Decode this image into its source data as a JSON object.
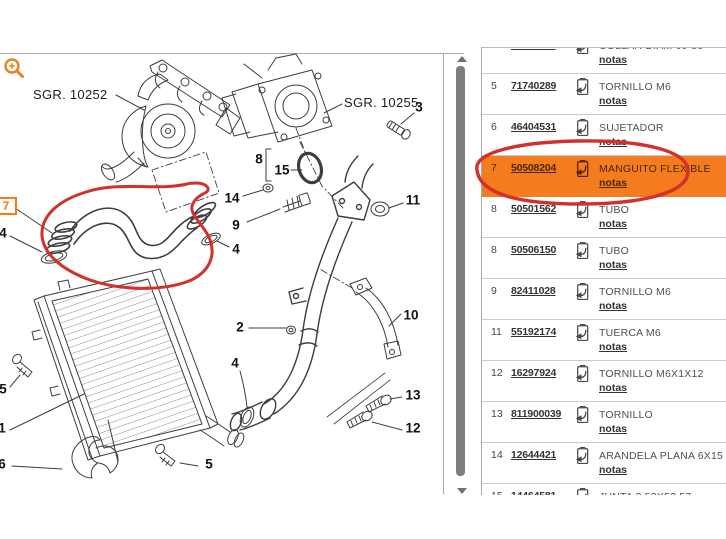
{
  "colors": {
    "accent_orange": "#f57c1e",
    "annotation_red": "#d2302a",
    "panel_border": "#a9a9a9",
    "row_separator": "#cccccc",
    "scrollbar_thumb": "#7d7d7d",
    "text_dark": "#333333",
    "text_desc": "#4f4f4f"
  },
  "diagram": {
    "zoom_icon": "magnifier-plus-icon",
    "sgr_labels": [
      {
        "text": "SGR. 10252"
      },
      {
        "text": "SGR. 10255"
      }
    ],
    "highlight_box_label": "7",
    "callouts": [
      {
        "label": "3",
        "x": 419,
        "y": 107
      },
      {
        "label": "8",
        "x": 259,
        "y": 159
      },
      {
        "label": "15",
        "x": 282,
        "y": 170
      },
      {
        "label": "14",
        "x": 232,
        "y": 198
      },
      {
        "label": "9",
        "x": 236,
        "y": 225
      },
      {
        "label": "11",
        "x": 413,
        "y": 200
      },
      {
        "label": "4",
        "x": 3,
        "y": 233
      },
      {
        "label": "4",
        "x": 236,
        "y": 249
      },
      {
        "label": "2",
        "x": 240,
        "y": 327
      },
      {
        "label": "4",
        "x": 235,
        "y": 363
      },
      {
        "label": "10",
        "x": 411,
        "y": 315
      },
      {
        "label": "13",
        "x": 413,
        "y": 395
      },
      {
        "label": "12",
        "x": 413,
        "y": 428
      },
      {
        "label": "5",
        "x": 3,
        "y": 389
      },
      {
        "label": "1",
        "x": 2,
        "y": 428
      },
      {
        "label": "6",
        "x": 2,
        "y": 464
      },
      {
        "label": "5",
        "x": 209,
        "y": 464
      }
    ]
  },
  "parts": {
    "notas_label": "notas",
    "row_icon": "transfer-part-icon",
    "rows": [
      {
        "num": "4",
        "part": "71714118",
        "desc": "COLLAR DIAM 60-80",
        "highlight": false
      },
      {
        "num": "5",
        "part": "71740289",
        "desc": "TORNILLO M6",
        "highlight": false
      },
      {
        "num": "6",
        "part": "46404531",
        "desc": "SUJETADOR",
        "highlight": false
      },
      {
        "num": "7",
        "part": "50508204",
        "desc": "MANGUITO FLEXIBLE",
        "highlight": true
      },
      {
        "num": "8",
        "part": "50501562",
        "desc": "TUBO",
        "highlight": false
      },
      {
        "num": "8",
        "part": "50506150",
        "desc": "TUBO",
        "highlight": false
      },
      {
        "num": "9",
        "part": "82411028",
        "desc": "TORNILLO M6",
        "highlight": false
      },
      {
        "num": "11",
        "part": "55192174",
        "desc": "TUERCA M6",
        "highlight": false
      },
      {
        "num": "12",
        "part": "16297924",
        "desc": "TORNILLO M6X1X12",
        "highlight": false
      },
      {
        "num": "13",
        "part": "811900039",
        "desc": "TORNILLO",
        "highlight": false
      },
      {
        "num": "14",
        "part": "12644421",
        "desc": "ARANDELA PLANA 6X15",
        "highlight": false
      },
      {
        "num": "15",
        "part": "14464581",
        "desc": "JUNTA 3,53X53,57",
        "highlight": false
      }
    ]
  }
}
